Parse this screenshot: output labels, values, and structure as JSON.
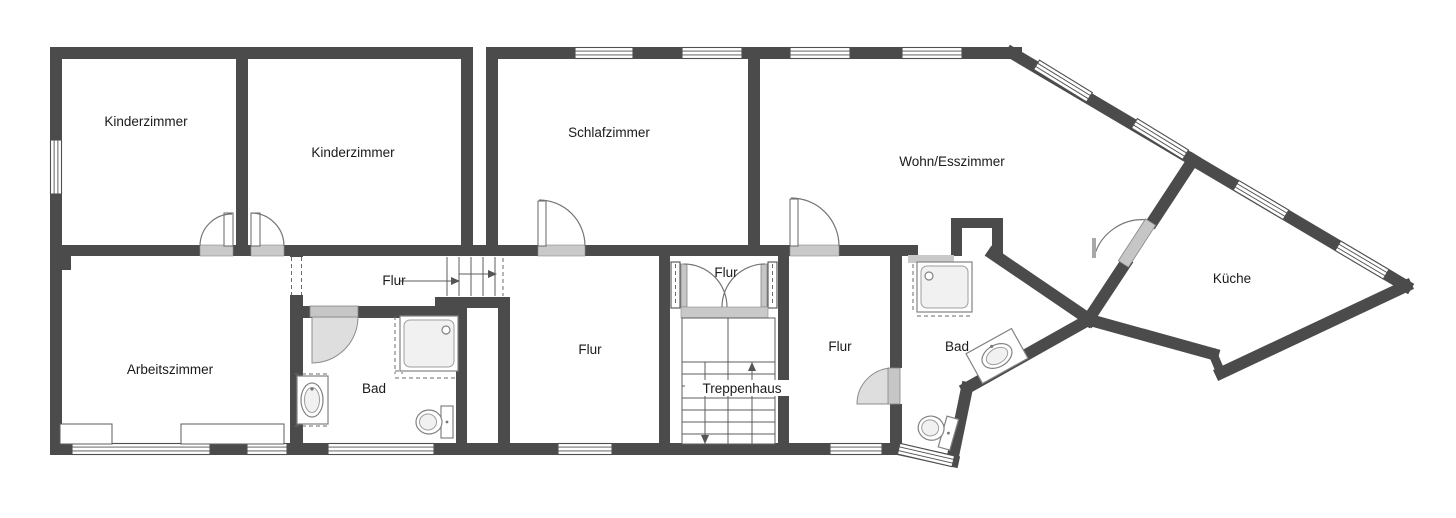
{
  "plan": {
    "type": "floor-plan",
    "rooms": [
      {
        "id": "kinderzimmer-1",
        "label": "Kinderzimmer"
      },
      {
        "id": "kinderzimmer-2",
        "label": "Kinderzimmer"
      },
      {
        "id": "schlafzimmer",
        "label": "Schlafzimmer"
      },
      {
        "id": "wohn-esszimmer",
        "label": "Wohn/Esszimmer"
      },
      {
        "id": "kueche",
        "label": "Küche"
      },
      {
        "id": "arbeitszimmer",
        "label": "Arbeitszimmer"
      },
      {
        "id": "flur-upper",
        "label": "Flur"
      },
      {
        "id": "flur-small",
        "label": "Flur"
      },
      {
        "id": "flur-center",
        "label": "Flur"
      },
      {
        "id": "flur-right",
        "label": "Flur"
      },
      {
        "id": "bad-1",
        "label": "Bad"
      },
      {
        "id": "bad-2",
        "label": "Bad"
      },
      {
        "id": "treppenhaus",
        "label": "Treppenhaus"
      }
    ],
    "colors": {
      "wall": "#4b4b4b",
      "door_leaf": "#c6c6c6",
      "swing": "#dedede",
      "window_line": "#4f4f4f",
      "fixture": "#828282",
      "text_color": "#1a1a1a",
      "background": "#ffffff"
    }
  }
}
